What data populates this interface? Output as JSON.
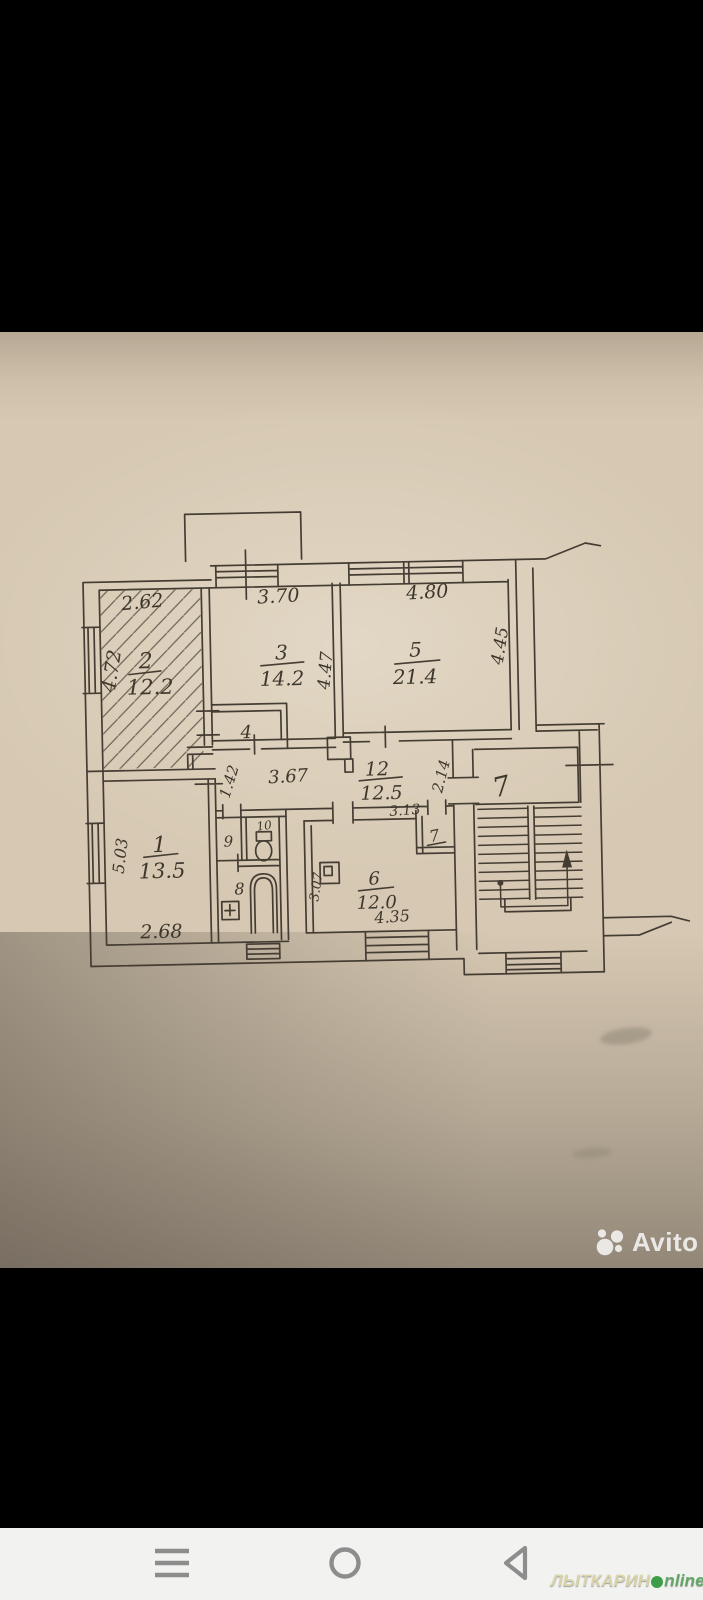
{
  "colors": {
    "paper": "#d6c8b2",
    "ink": "#3e372c",
    "nav_icon_gray": "#8d8d8d",
    "watermark_white": "rgba(255,255,255,0.80)",
    "site_cream": "#ded8a8",
    "site_green": "#4ba35c"
  },
  "photo": {
    "watermark": {
      "logo_icon": "avito-dots-logo",
      "label": "Avito"
    },
    "plan": {
      "room1": {
        "num": "1",
        "area": "13.5",
        "dim_left": "5.03",
        "dim_bottom": "2.68"
      },
      "room2": {
        "num": "2",
        "area": "12.2",
        "dim_top": "2.62",
        "dim_left": "4.72"
      },
      "room3": {
        "num": "3",
        "area": "14.2",
        "dim_top": "3.70",
        "dim_right": "4.47"
      },
      "room4": {
        "num": "4"
      },
      "room5": {
        "num": "5",
        "area": "21.4",
        "dim_top": "4.80",
        "dim_right": "4.45"
      },
      "room6": {
        "num": "6",
        "area": "12.0",
        "dim_left": "3.07",
        "dim_bottom": "4.35"
      },
      "room8": {
        "num": "8"
      },
      "room9": {
        "num": "9"
      },
      "room10": {
        "num": "10"
      },
      "corridor": {
        "num": "12",
        "area": "12.5",
        "dim_width": "3.67",
        "dim_left_v": "1.42",
        "dim_right_h": "3.13",
        "dim_right_v": "2.14"
      },
      "stairwell": {
        "num": "7"
      },
      "closet7": {
        "num": "7"
      }
    }
  },
  "navbar": {
    "menu_icon": "menu-bars",
    "home_icon": "home-circle",
    "back_icon": "back-triangle"
  },
  "site_watermark": {
    "prefix": "ЛЫТКАРИН",
    "suffix": "nline"
  }
}
